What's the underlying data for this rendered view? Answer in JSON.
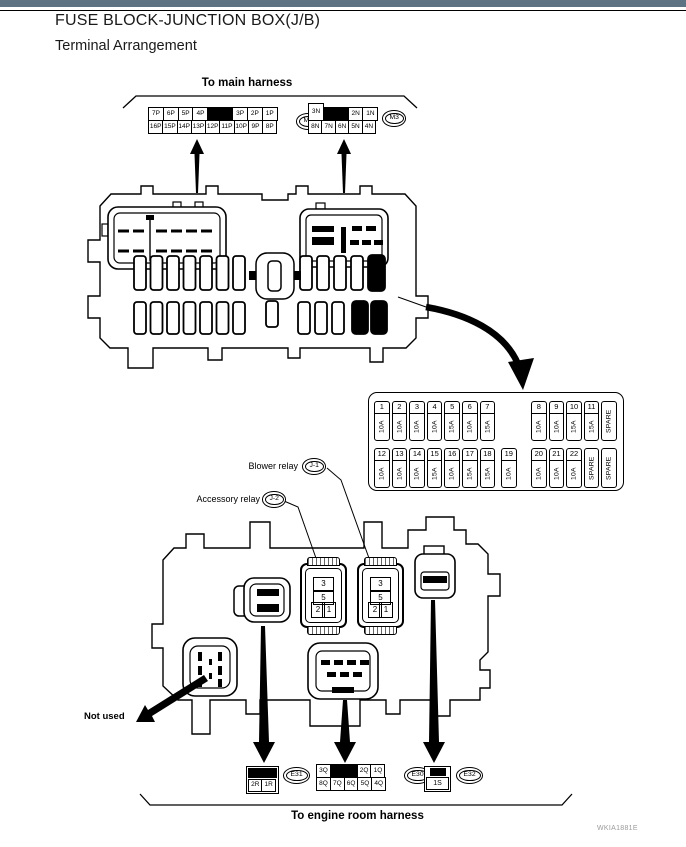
{
  "page": {
    "title": "FUSE BLOCK-JUNCTION BOX(J/B)",
    "subtitle": "Terminal Arrangement",
    "watermark": "WKIA1881E",
    "top_bar_color": "#5d7383"
  },
  "labels": {
    "to_main_harness": "To main harness",
    "to_engine_room_harness": "To engine room harness",
    "blower_relay": "Blower relay",
    "accessory_relay": "Accessory relay",
    "not_used": "Not used"
  },
  "badges": {
    "m4": "M4",
    "m3": "M3",
    "j1": "J-1",
    "j2": "J-2",
    "e31": "E31",
    "e30": "E30",
    "e32": "E32"
  },
  "connectors": {
    "m4": {
      "row1": [
        {
          "t": "7P"
        },
        {
          "t": "6P"
        },
        {
          "t": "5P"
        },
        {
          "t": "4P"
        },
        {
          "fill": true
        },
        {
          "t": "3P"
        },
        {
          "t": "2P"
        },
        {
          "t": "1P"
        }
      ],
      "row2": [
        {
          "t": "16P"
        },
        {
          "t": "15P"
        },
        {
          "t": "14P"
        },
        {
          "t": "13P"
        },
        {
          "t": "12P"
        },
        {
          "t": "11P"
        },
        {
          "t": "10P"
        },
        {
          "t": "9P"
        },
        {
          "t": "8P"
        }
      ]
    },
    "m3": {
      "row1": [
        {
          "t": "3N",
          "tall": true
        },
        {
          "fill": true
        },
        {
          "t": "2N"
        },
        {
          "t": "1N"
        }
      ],
      "row2": [
        {
          "t": "8N"
        },
        {
          "t": "7N"
        },
        {
          "t": "6N"
        },
        {
          "t": "5N"
        },
        {
          "t": "4N"
        }
      ]
    },
    "e30": {
      "row1": [
        {
          "t": "3Q"
        },
        {
          "fill": true
        },
        {
          "t": "2Q"
        },
        {
          "t": "1Q"
        }
      ],
      "row2": [
        {
          "t": "8Q"
        },
        {
          "t": "7Q"
        },
        {
          "t": "6Q"
        },
        {
          "t": "5Q"
        },
        {
          "t": "4Q"
        }
      ]
    },
    "e31": {
      "row2": [
        {
          "t": "2R"
        },
        {
          "t": "1R"
        }
      ]
    },
    "e32": {
      "row2": [
        {
          "t": "1S"
        }
      ]
    }
  },
  "relay": {
    "cell_top": "3",
    "cell_mid": "5",
    "cell_left": "2",
    "cell_right": "1"
  },
  "fuse_panel": {
    "row1_left": [
      {
        "n": "1",
        "a": "10A"
      },
      {
        "n": "2",
        "a": "10A"
      },
      {
        "n": "3",
        "a": "10A"
      },
      {
        "n": "4",
        "a": "10A"
      },
      {
        "n": "5",
        "a": "15A"
      },
      {
        "n": "6",
        "a": "10A"
      },
      {
        "n": "7",
        "a": "15A"
      }
    ],
    "row1_right": [
      {
        "n": "8",
        "a": "10A"
      },
      {
        "n": "9",
        "a": "10A"
      },
      {
        "n": "10",
        "a": "15A"
      },
      {
        "n": "11",
        "a": "15A"
      },
      {
        "a": "SPARE",
        "spare": true
      }
    ],
    "row2_left": [
      {
        "n": "12",
        "a": "10A"
      },
      {
        "n": "13",
        "a": "10A"
      },
      {
        "n": "14",
        "a": "10A"
      },
      {
        "n": "15",
        "a": "15A"
      },
      {
        "n": "16",
        "a": "10A"
      },
      {
        "n": "17",
        "a": "15A"
      },
      {
        "n": "18",
        "a": "15A"
      }
    ],
    "row2_mid": [
      {
        "n": "19",
        "a": "10A"
      }
    ],
    "row2_right": [
      {
        "n": "20",
        "a": "10A"
      },
      {
        "n": "21",
        "a": "10A"
      },
      {
        "n": "22",
        "a": "10A"
      },
      {
        "a": "SPARE",
        "spare": true
      },
      {
        "a": "SPARE",
        "spare": true
      }
    ]
  }
}
